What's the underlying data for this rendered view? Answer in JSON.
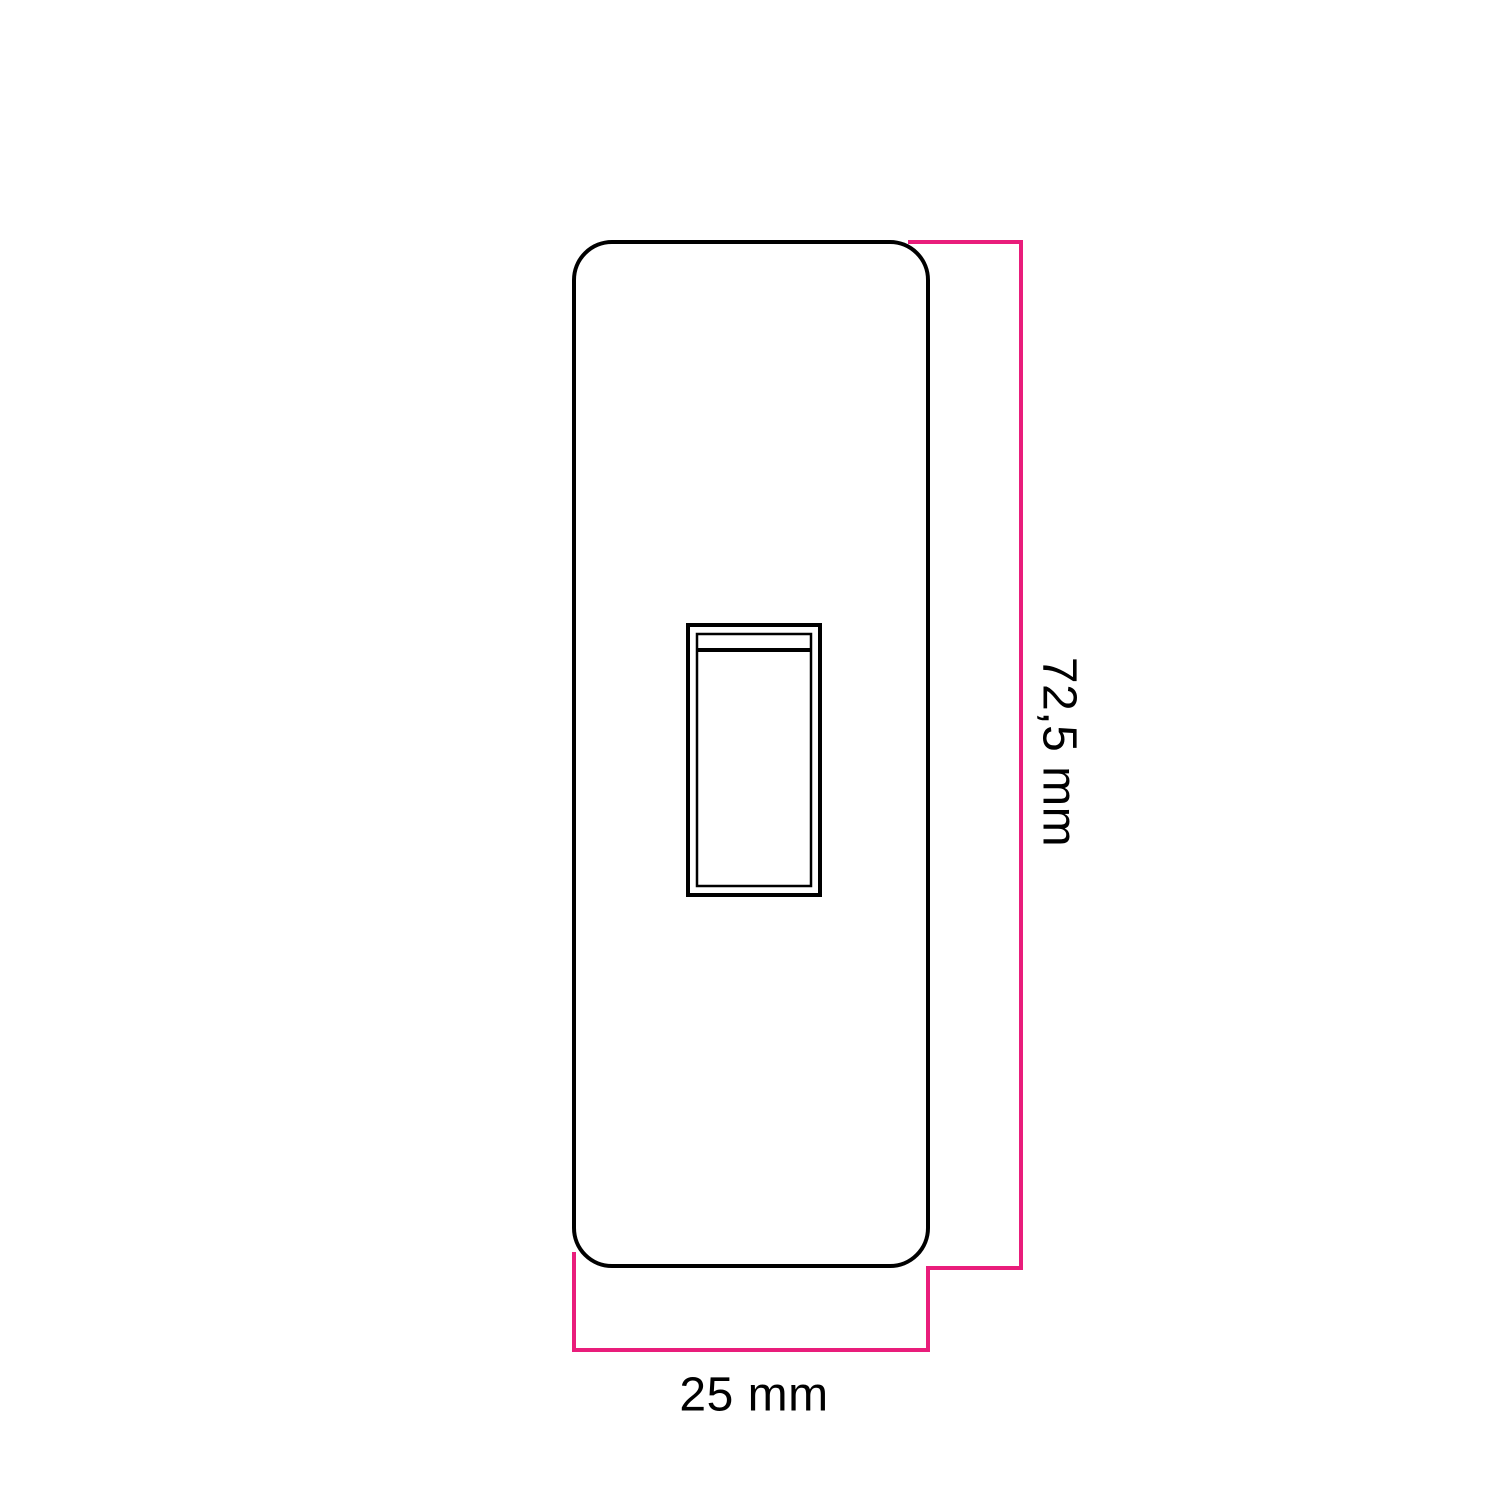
{
  "drawing": {
    "height_label": "72,5 mm",
    "width_label": "25 mm"
  },
  "colors": {
    "outline": "#000000",
    "dimension": "#e91d7b",
    "background": "#ffffff"
  }
}
